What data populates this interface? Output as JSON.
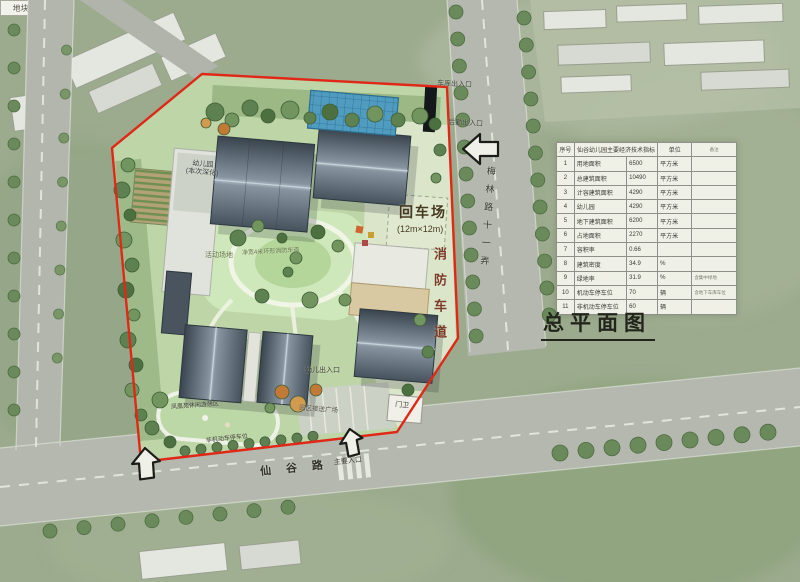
{
  "title": "总平面图",
  "surroundings": {
    "parcel_label": "地块 5"
  },
  "roads": {
    "right_road_name": "梅林路十一弄",
    "bottom_road_name": "仙谷路"
  },
  "entrances": {
    "garage": "车库出入口",
    "logistics": "后勤出入口",
    "main": "主要入口",
    "child": "幼儿出入口"
  },
  "plan": {
    "turnaround": "回车场",
    "turnaround_size": "(12m×12m)",
    "fire_lane": "消防车道",
    "ring_road": "净宽4米环形消防车道",
    "activity_field": "活动场地",
    "building_label_line1": "幼儿园",
    "building_label_line2": "(本次深化)",
    "plaza": "园区接送广场",
    "guard": "门卫",
    "bike_parking": "非机动车停车位",
    "leisure": "凤凰苑休闲游憩区"
  },
  "table": {
    "col_no": "序号",
    "title": "仙谷幼儿园主要经济技术指标",
    "col_unit": "单位",
    "col_note": "备注",
    "rows": [
      {
        "no": "1",
        "name": "用地面积",
        "value": "6500",
        "unit": "平方米",
        "note": ""
      },
      {
        "no": "2",
        "name": "总建筑面积",
        "value": "10490",
        "unit": "平方米",
        "note": ""
      },
      {
        "no": "3",
        "name": "计容建筑面积",
        "value": "4290",
        "unit": "平方米",
        "note": ""
      },
      {
        "no": "4",
        "name": "幼儿园",
        "value": "4290",
        "unit": "平方米",
        "note": ""
      },
      {
        "no": "5",
        "name": "地下建筑面积",
        "value": "6200",
        "unit": "平方米",
        "note": ""
      },
      {
        "no": "6",
        "name": "占地面积",
        "value": "2270",
        "unit": "平方米",
        "note": ""
      },
      {
        "no": "7",
        "name": "容积率",
        "value": "0.66",
        "unit": "",
        "note": ""
      },
      {
        "no": "8",
        "name": "建筑密度",
        "value": "34.9",
        "unit": "%",
        "note": ""
      },
      {
        "no": "9",
        "name": "绿地率",
        "value": "31.9",
        "unit": "%",
        "note": "含集中绿地"
      },
      {
        "no": "10",
        "name": "机动车停车位",
        "value": "70",
        "unit": "辆",
        "note": "含地下车库车位"
      },
      {
        "no": "11",
        "name": "非机动车停车位",
        "value": "60",
        "unit": "辆",
        "note": ""
      }
    ]
  },
  "colors": {
    "boundary": "#e02818",
    "roof_dark": "#46525e",
    "pool_blue": "#4f9cc0"
  }
}
